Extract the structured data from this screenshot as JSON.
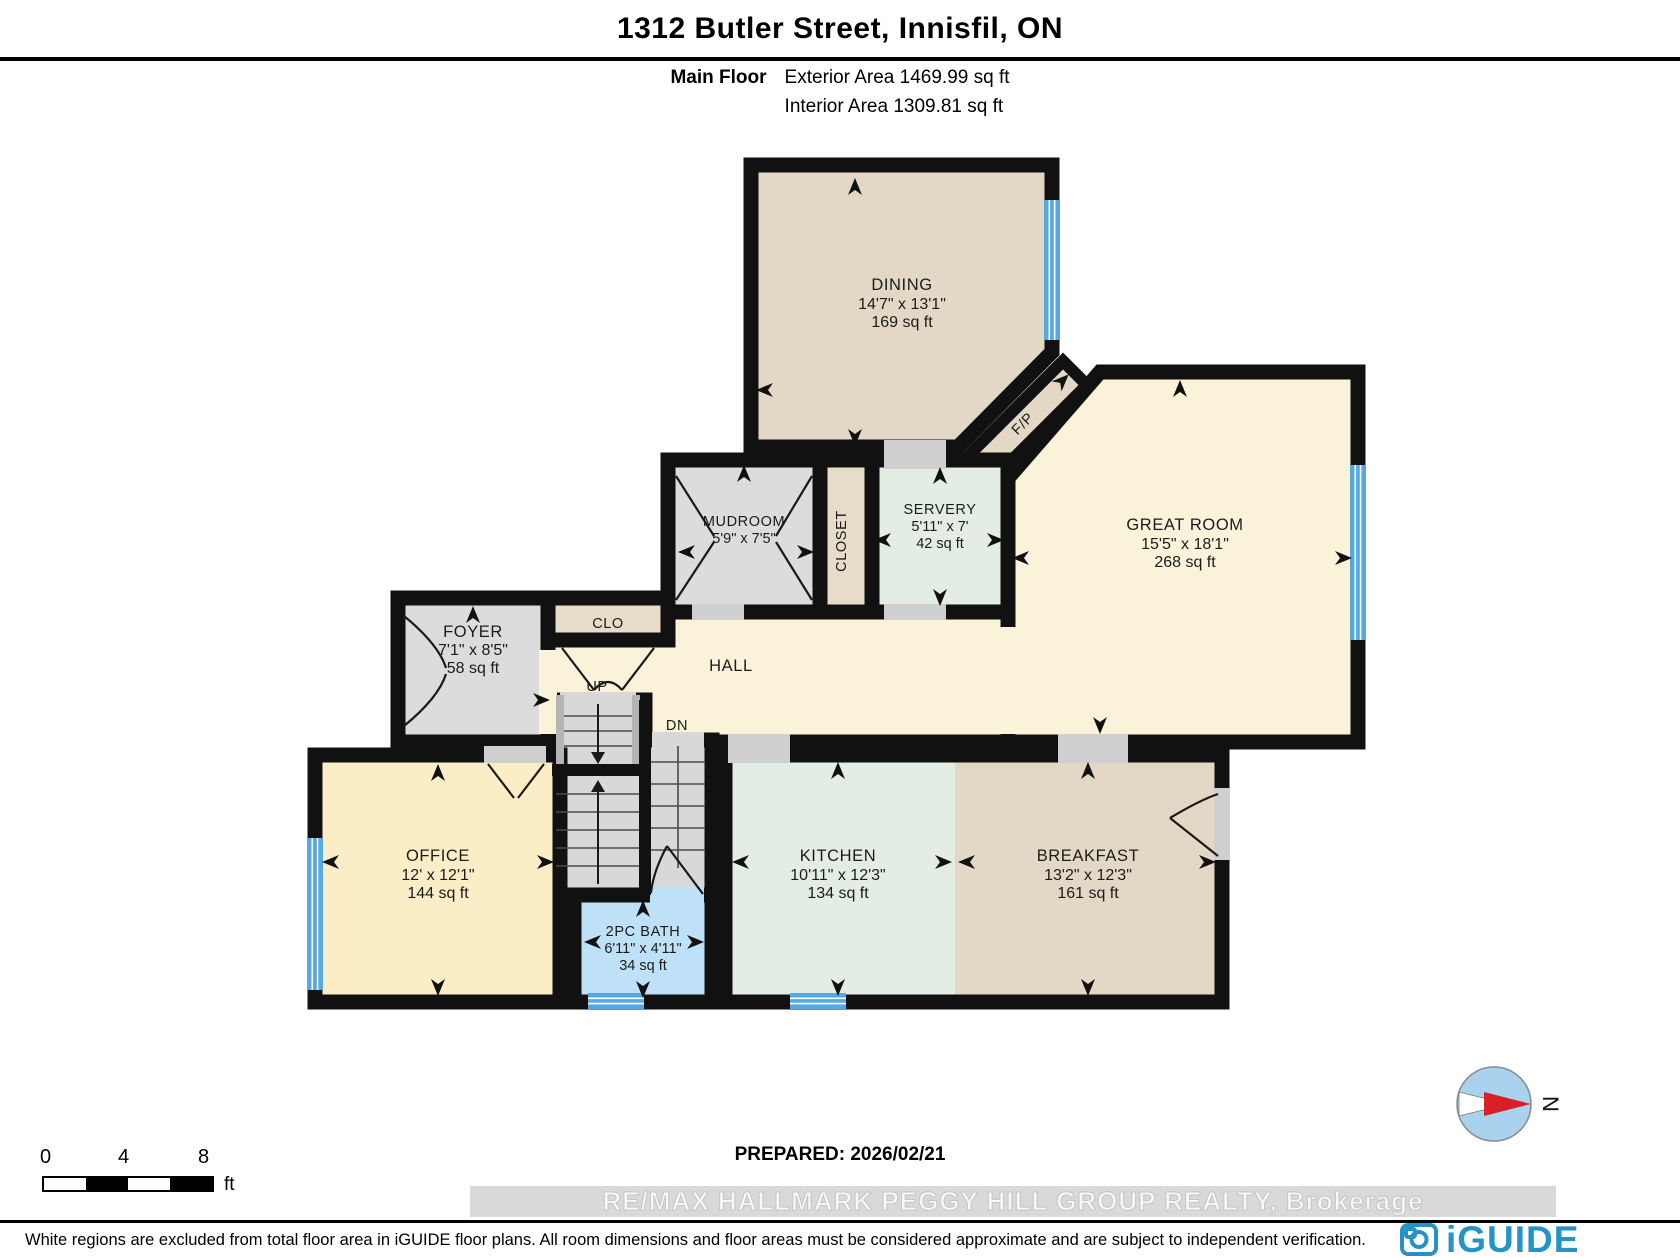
{
  "header": {
    "title": "1312 Butler Street, Innisfil, ON",
    "floor_label": "Main Floor",
    "exterior_area": "Exterior Area 1469.99 sq ft",
    "interior_area": "Interior Area 1309.81 sq ft"
  },
  "rooms": {
    "dining": {
      "name": "DINING",
      "dims": "14'7\" x 13'1\"",
      "area": "169 sq ft"
    },
    "great_room": {
      "name": "GREAT ROOM",
      "dims": "15'5\" x 18'1\"",
      "area": "268 sq ft"
    },
    "servery": {
      "name": "SERVERY",
      "dims": "5'11\" x 7'",
      "area": "42 sq ft"
    },
    "mudroom": {
      "name": "MUDROOM",
      "dims": "5'9\" x 7'5\""
    },
    "closet": {
      "name": "CLOSET"
    },
    "clo": {
      "name": "CLO"
    },
    "foyer": {
      "name": "FOYER",
      "dims": "7'1\" x 8'5\"",
      "area": "58 sq ft"
    },
    "hall": {
      "name": "HALL"
    },
    "fireplace": {
      "name": "F/P"
    },
    "stairs_up": {
      "name": "UP"
    },
    "stairs_dn": {
      "name": "DN"
    },
    "office": {
      "name": "OFFICE",
      "dims": "12' x 12'1\"",
      "area": "144 sq ft"
    },
    "kitchen": {
      "name": "KITCHEN",
      "dims": "10'11\" x 12'3\"",
      "area": "134 sq ft"
    },
    "breakfast": {
      "name": "BREAKFAST",
      "dims": "13'2\" x 12'3\"",
      "area": "161 sq ft"
    },
    "bath": {
      "name": "2PC BATH",
      "dims": "6'11\" x 4'11\"",
      "area": "34 sq ft"
    }
  },
  "scale_bar": {
    "tick_0": "0",
    "tick_4": "4",
    "tick_8": "8",
    "unit": "ft"
  },
  "prepared_label": "PREPARED: 2026/02/21",
  "watermark": "RE/MAX HALLMARK PEGGY HILL GROUP REALTY, Brokerage",
  "disclaimer": "White regions are excluded from total floor area in iGUIDE floor plans. All room dimensions and floor areas must be considered approximate and are subject to independent verification.",
  "branding": {
    "logo_text": "iGUIDE",
    "compass_label": "N"
  },
  "colors": {
    "wall": "#111111",
    "window_blue": "#55a9e0",
    "room_beige": "#e3d8c6",
    "room_cream": "#faf3da",
    "room_yellow": "#fbedc6",
    "room_green": "#e4ede3",
    "room_blue": "#bfe1f8",
    "room_gray": "#dcdcdc",
    "sill_gray": "#cfcfcf",
    "logo_blue": "#2693c6",
    "compass_red": "#d81f26"
  }
}
